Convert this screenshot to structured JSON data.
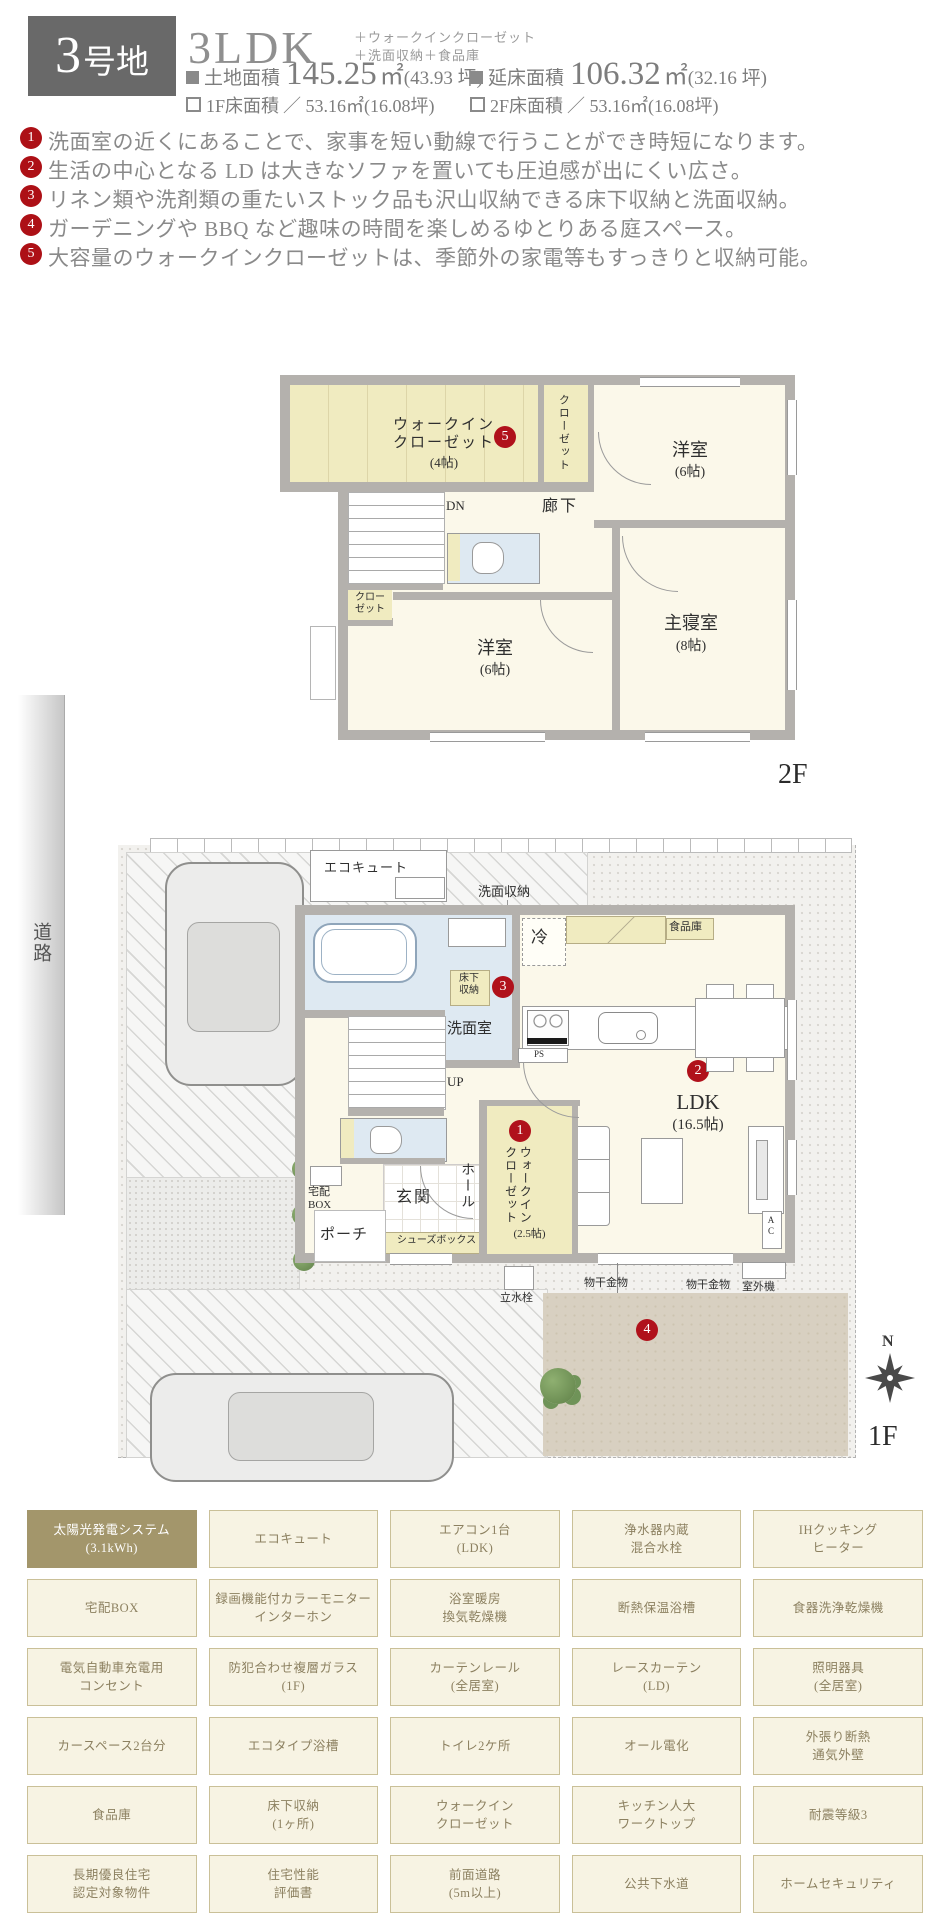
{
  "header": {
    "lot_num": "3",
    "lot_suffix": "号地",
    "plan_type": "3LDK",
    "plan_extra1": "＋ウォークインクローゼット",
    "plan_extra2": "＋洗面収納＋食品庫",
    "area_row1": [
      {
        "label": "土地面積",
        "value": "145.25",
        "unit": "㎡",
        "tsubo": "(43.93 坪)"
      },
      {
        "label": "延床面積",
        "value": "106.32",
        "unit": "㎡",
        "tsubo": "(32.16 坪)"
      }
    ],
    "area_row2": [
      {
        "label": "1F床面積",
        "value": "／ 53.16㎡",
        "tsubo": "(16.08坪)"
      },
      {
        "label": "2F床面積",
        "value": "／ 53.16㎡",
        "tsubo": "(16.08坪)"
      }
    ]
  },
  "features": [
    {
      "num": "1",
      "text": "洗面室の近くにあることで、家事を短い動線で行うことができ時短になります。"
    },
    {
      "num": "2",
      "text": "生活の中心となる LD は大きなソファを置いても圧迫感が出にくい広さ。"
    },
    {
      "num": "3",
      "text": "リネン類や洗剤類の重たいストック品も沢山収納できる床下収納と洗面収納。"
    },
    {
      "num": "4",
      "text": "ガーデニングや BBQ など趣味の時間を楽しめるゆとりある庭スペース。"
    },
    {
      "num": "5",
      "text": "大容量のウォークインクローゼットは、季節外の家電等もすっきりと収納可能。"
    }
  ],
  "plan2f": {
    "floor_label": "2F",
    "wic_name": "ウォークイン\nクローゼット",
    "wic_size": "(4帖)",
    "wic_num": "5",
    "closet1": "クローゼット",
    "room1_name": "洋室",
    "room1_size": "(6帖)",
    "dn": "DN",
    "hallway": "廊下",
    "closet2": "クロー\nゼット",
    "room2_name": "洋室",
    "room2_size": "(6帖)",
    "master_name": "主寝室",
    "master_size": "(8帖)"
  },
  "plan1f": {
    "floor_label": "1F",
    "road": "道路",
    "compass": "N",
    "ecocute": "エコキュート",
    "senmen_shunou": "洗面収納",
    "bath": "浴室",
    "yukashita": "床下\n収納",
    "yukashita_num": "3",
    "fridge": "冷",
    "pantry": "食品庫",
    "wash": "洗",
    "senmenshitsu": "洗面室",
    "up": "UP",
    "ps": "PS",
    "ldk_num": "2",
    "ldk": "LDK",
    "ldk_size": "(16.5帖)",
    "wic_num": "1",
    "wic": "ウォークイン\nクローゼット",
    "wic_size": "(2.5帖)",
    "hall": "ホール",
    "genkan": "玄関",
    "shoes": "シューズボックス",
    "porch": "ポーチ",
    "takuhai": "宅配\nBOX",
    "rissuisen": "立水栓",
    "monohoshi1": "物干金物",
    "monohoshi2": "物干金物",
    "outdoor_unit": "室外機",
    "ac": "A\nC",
    "garden_num": "4"
  },
  "equipment": {
    "cells": [
      {
        "text": "太陽光発電システム\n(3.1kWh)",
        "highlight": true
      },
      {
        "text": "エコキュート"
      },
      {
        "text": "エアコン1台\n(LDK)"
      },
      {
        "text": "浄水器内蔵\n混合水栓"
      },
      {
        "text": "IHクッキング\nヒーター"
      },
      {
        "text": "宅配BOX"
      },
      {
        "text": "録画機能付カラーモニター\nインターホン"
      },
      {
        "text": "浴室暖房\n換気乾燥機"
      },
      {
        "text": "断熱保温浴槽"
      },
      {
        "text": "食器洗浄乾燥機"
      },
      {
        "text": "電気自動車充電用\nコンセント"
      },
      {
        "text": "防犯合わせ複層ガラス\n(1F)"
      },
      {
        "text": "カーテンレール\n(全居室)"
      },
      {
        "text": "レースカーテン\n(LD)"
      },
      {
        "text": "照明器具\n(全居室)"
      },
      {
        "text": "カースペース2台分"
      },
      {
        "text": "エコタイプ浴槽"
      },
      {
        "text": "トイレ2ケ所"
      },
      {
        "text": "オール電化"
      },
      {
        "text": "外張り断熱\n通気外壁"
      },
      {
        "text": "食品庫"
      },
      {
        "text": "床下収納\n(1ヶ所)"
      },
      {
        "text": "ウォークイン\nクローゼット"
      },
      {
        "text": "キッチン人大\nワークトップ"
      },
      {
        "text": "耐震等級3"
      },
      {
        "text": "長期優良住宅\n認定対象物件"
      },
      {
        "text": "住宅性能\n評価書"
      },
      {
        "text": "前面道路\n(5m以上)"
      },
      {
        "text": "公共下水道"
      },
      {
        "text": "ホームセキュリティ"
      }
    ]
  },
  "colors": {
    "accent_red": "#b0111b",
    "badge_gray": "#696969",
    "table_highlight": "#a3966b",
    "wall_gray": "#b4b1ad",
    "room_cream": "#fbf8ea",
    "closet_yellow": "#f0ebc0",
    "bath_blue": "#dee9f2",
    "garden_tan": "#d8d0c1"
  }
}
